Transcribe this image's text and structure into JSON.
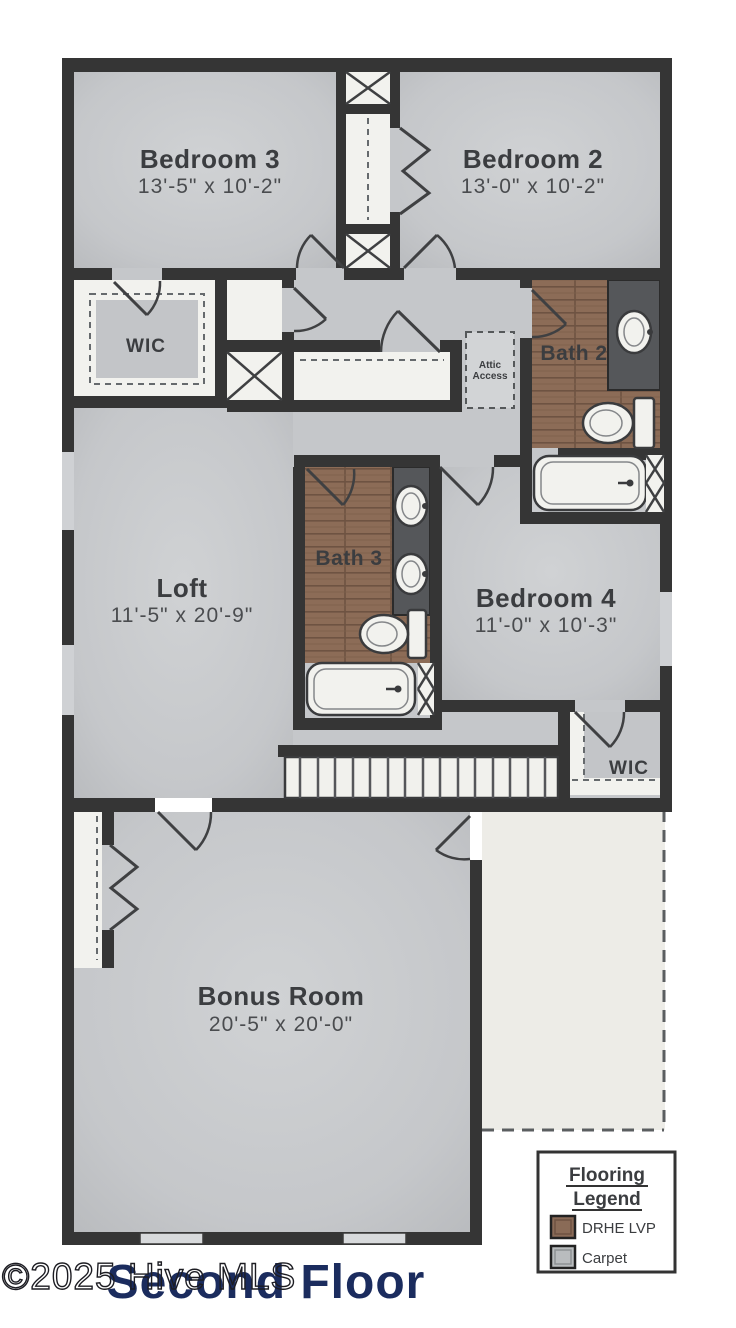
{
  "page": {
    "title": "Second Floor",
    "watermark": "©2025 Hive MLS"
  },
  "rooms": {
    "bedroom3": {
      "name": "Bedroom 3",
      "dims": "13'-5\" x 10'-2\""
    },
    "bedroom2": {
      "name": "Bedroom 2",
      "dims": "13'-0\" x 10'-2\""
    },
    "wic_upper": {
      "name": "WIC"
    },
    "bath2": {
      "name": "Bath 2"
    },
    "attic": {
      "line1": "Attic",
      "line2": "Access"
    },
    "loft": {
      "name": "Loft",
      "dims": "11'-5\" x 20'-9\""
    },
    "bath3": {
      "name": "Bath 3"
    },
    "bedroom4": {
      "name": "Bedroom 4",
      "dims": "11'-0\" x 10'-3\""
    },
    "wic_lower": {
      "name": "WIC"
    },
    "bonus": {
      "name": "Bonus Room",
      "dims": "20'-5\" x 20'-0\""
    }
  },
  "legend": {
    "title_line1": "Flooring",
    "title_line2": "Legend",
    "items": [
      {
        "label": "DRHE LVP",
        "color": "#8a6b57"
      },
      {
        "label": "Carpet",
        "color": "#b9bcbe"
      }
    ]
  },
  "colors": {
    "wall": "#353535",
    "carpet": "#c5c7ca",
    "wood": "#8c6c57",
    "counter": "#55575a",
    "unfinished": "#edece7",
    "title": "#1b2c5e"
  }
}
